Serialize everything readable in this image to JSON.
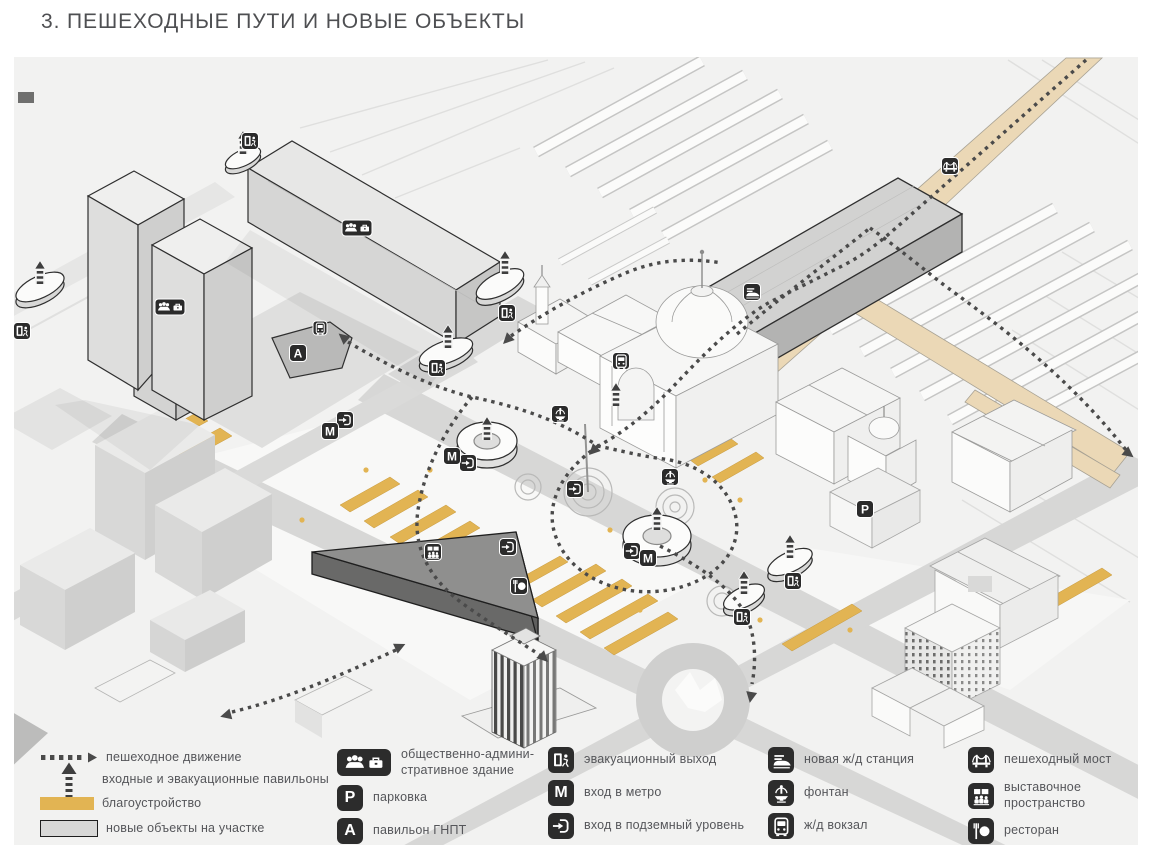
{
  "title": "3. ПЕШЕХОДНЫЕ ПУТИ И НОВЫЕ ОБЪЕКТЫ",
  "colors": {
    "map_background": "#f2f2f1",
    "road_gray": "#d7d7d6",
    "landscaping_yellow": "#e2b453",
    "walkway_tan": "#ebd8b6",
    "icon_background": "#2c2c2c",
    "path_dot_gray": "#4a4a4a"
  },
  "icons": {
    "metro_letter": "M",
    "parking_letter": "P",
    "pavilion_letter": "A"
  },
  "legend": {
    "lines": [
      {
        "symbol": "dotted-path",
        "label": "пешеходное движение"
      },
      {
        "symbol": "entrance-arrow",
        "label": "входные и эвакуационные павильоны"
      },
      {
        "symbol": "yellow-swatch",
        "label": "благоустройство"
      },
      {
        "symbol": "gray-swatch",
        "label": "новые объекты на участке"
      }
    ],
    "groups": [
      {
        "items": [
          {
            "icon": "admin-building-icon",
            "label": "общественно-админи-\nстративное здание"
          },
          {
            "icon": "parking-icon",
            "label": "парковка"
          },
          {
            "icon": "gnpt-pavilion-icon",
            "label": "павильон ГНПТ"
          }
        ]
      },
      {
        "items": [
          {
            "icon": "evacuation-exit-icon",
            "label": "эвакуационный выход"
          },
          {
            "icon": "metro-entrance-icon",
            "label": "вход в метро"
          },
          {
            "icon": "underground-entrance-icon",
            "label": "вход в подземный уровень"
          }
        ]
      },
      {
        "items": [
          {
            "icon": "new-rail-station-icon",
            "label": "новая ж/д станция"
          },
          {
            "icon": "fountain-icon",
            "label": "фонтан"
          },
          {
            "icon": "rail-terminal-icon",
            "label": "ж/д вокзал"
          }
        ]
      },
      {
        "items": [
          {
            "icon": "pedestrian-bridge-icon",
            "label": "пешеходный мост"
          },
          {
            "icon": "exhibition-space-icon",
            "label": "выставочное\nпространство"
          },
          {
            "icon": "restaurant-icon",
            "label": "ресторан"
          }
        ]
      }
    ]
  }
}
